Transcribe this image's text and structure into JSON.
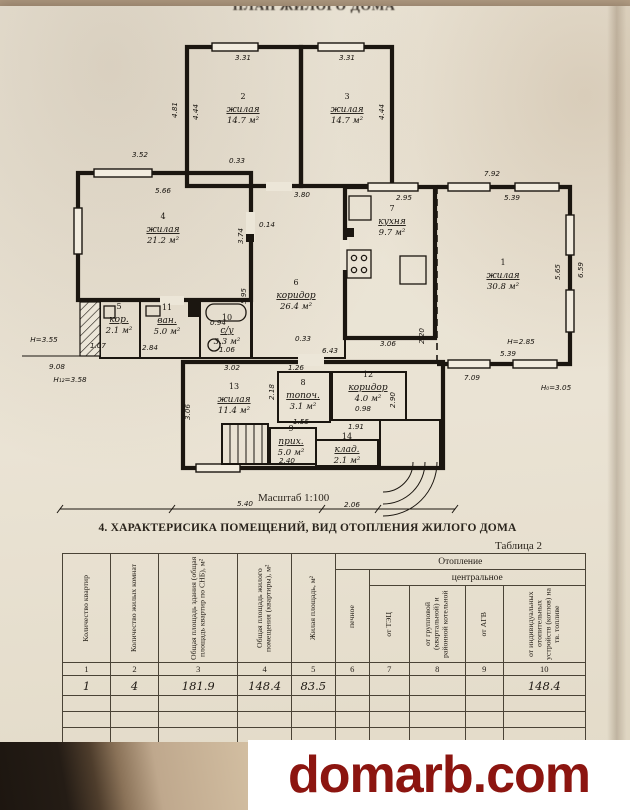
{
  "document": {
    "top_fragment": "ПЛАН ЖИЛОГО ДОМА",
    "scale_label": "Масштаб 1:100",
    "section_heading": "4. ХАРАКТЕРИСИКА ПОМЕЩЕНИЙ, ВИД ОТОПЛЕНИЯ ЖИЛОГО ДОМА",
    "table_caption": "Таблица 2"
  },
  "plan": {
    "rooms": [
      {
        "num": "1",
        "name": "жилая",
        "area": "30.8 м²",
        "x": 503,
        "y": 278
      },
      {
        "num": "2",
        "name": "жилая",
        "area": "14.7 м²",
        "x": 243,
        "y": 112
      },
      {
        "num": "3",
        "name": "жилая",
        "area": "14.7 м²",
        "x": 347,
        "y": 112
      },
      {
        "num": "4",
        "name": "жилая",
        "area": "21.2 м²",
        "x": 163,
        "y": 232
      },
      {
        "num": "5",
        "name": "кор.",
        "area": "2.1 м²",
        "x": 119,
        "y": 322
      },
      {
        "num": "6",
        "name": "коридор",
        "area": "26.4 м²",
        "x": 296,
        "y": 298
      },
      {
        "num": "7",
        "name": "кухня",
        "area": "9.7 м²",
        "x": 392,
        "y": 224
      },
      {
        "num": "8",
        "name": "топоч.",
        "area": "3.1 м²",
        "x": 303,
        "y": 398
      },
      {
        "num": "9",
        "name": "прих.",
        "area": "5.0 м²",
        "x": 291,
        "y": 444
      },
      {
        "num": "10",
        "name": "с/у",
        "area": "3.3 м²",
        "x": 227,
        "y": 333
      },
      {
        "num": "11",
        "name": "ван.",
        "area": "5.0 м²",
        "x": 167,
        "y": 323
      },
      {
        "num": "12",
        "name": "коридор",
        "area": "4.0 м²",
        "x": 368,
        "y": 390
      },
      {
        "num": "13",
        "name": "жилая",
        "area": "11.4 м²",
        "x": 234,
        "y": 402
      },
      {
        "num": "14",
        "name": "клад.",
        "area": "2.1 м²",
        "x": 347,
        "y": 452
      }
    ],
    "dims": [
      {
        "t": "3.52",
        "x": 140,
        "y": 157
      },
      {
        "t": "0.33",
        "x": 237,
        "y": 163
      },
      {
        "t": "5.66",
        "x": 163,
        "y": 193
      },
      {
        "t": "3.80",
        "x": 302,
        "y": 197
      },
      {
        "t": "3.31",
        "x": 243,
        "y": 60
      },
      {
        "t": "3.31",
        "x": 347,
        "y": 60
      },
      {
        "t": "4.81",
        "x": 177,
        "y": 110,
        "r": -90
      },
      {
        "t": "4.44",
        "x": 198,
        "y": 112,
        "r": -90
      },
      {
        "t": "4.44",
        "x": 384,
        "y": 112,
        "r": -90
      },
      {
        "t": "7.92",
        "x": 492,
        "y": 176
      },
      {
        "t": "5.39",
        "x": 512,
        "y": 200
      },
      {
        "t": "2.95",
        "x": 404,
        "y": 200
      },
      {
        "t": "5.65",
        "x": 560,
        "y": 272,
        "r": -90
      },
      {
        "t": "6.59",
        "x": 583,
        "y": 270,
        "r": -90
      },
      {
        "t": "5.39",
        "x": 508,
        "y": 356
      },
      {
        "t": "7.09",
        "x": 472,
        "y": 380
      },
      {
        "t": "Н=2.85",
        "x": 521,
        "y": 344
      },
      {
        "t": "Н₀=3.05",
        "x": 556,
        "y": 390
      },
      {
        "t": "3.74",
        "x": 243,
        "y": 236,
        "r": -90
      },
      {
        "t": "0.14",
        "x": 267,
        "y": 227
      },
      {
        "t": "5.95",
        "x": 246,
        "y": 296,
        "r": -90
      },
      {
        "t": "3.06",
        "x": 388,
        "y": 346
      },
      {
        "t": "2.20",
        "x": 424,
        "y": 336,
        "r": -90
      },
      {
        "t": "6.43",
        "x": 330,
        "y": 353
      },
      {
        "t": "0.33",
        "x": 303,
        "y": 341
      },
      {
        "t": "Н=3.55",
        "x": 44,
        "y": 342
      },
      {
        "t": "9.08",
        "x": 57,
        "y": 369
      },
      {
        "t": "Н₁₂=3.58",
        "x": 70,
        "y": 382
      },
      {
        "t": "1.07",
        "x": 98,
        "y": 348
      },
      {
        "t": "2.84",
        "x": 150,
        "y": 350
      },
      {
        "t": "0.94",
        "x": 218,
        "y": 325
      },
      {
        "t": "1.06",
        "x": 227,
        "y": 352
      },
      {
        "t": "3.02",
        "x": 232,
        "y": 370
      },
      {
        "t": "3.06",
        "x": 190,
        "y": 412,
        "r": -90
      },
      {
        "t": "1.26",
        "x": 296,
        "y": 370
      },
      {
        "t": "2.18",
        "x": 274,
        "y": 392,
        "r": -90
      },
      {
        "t": "1.55",
        "x": 301,
        "y": 424
      },
      {
        "t": "0.98",
        "x": 363,
        "y": 411
      },
      {
        "t": "1.91",
        "x": 356,
        "y": 429
      },
      {
        "t": "2.90",
        "x": 395,
        "y": 400,
        "r": -90
      },
      {
        "t": "2.40",
        "x": 287,
        "y": 463
      },
      {
        "t": "5.40",
        "x": 245,
        "y": 506
      },
      {
        "t": "2.06",
        "x": 352,
        "y": 507
      }
    ]
  },
  "table": {
    "heating_label": "Отопление",
    "central_label": "центральное",
    "columns": [
      "Количество квартир",
      "Количество жилых комнат",
      "Общая площадь здания (общая площадь квартир по СНБ), м²",
      "Общая площадь жилого помещения (квартиры), м²",
      "Жилая площадь, м²",
      "печное",
      "от ТЭЦ",
      "от групповой (квартальной) и районной котельной",
      "от АГВ",
      "от индивидуальных отопительных устройств (котлов) на тв. топливе"
    ],
    "column_numbers": [
      "1",
      "2",
      "3",
      "4",
      "5",
      "6",
      "7",
      "8",
      "9",
      "10"
    ],
    "data_row": [
      "1",
      "4",
      "181.9",
      "148.4",
      "83.5",
      "",
      "",
      "",
      "",
      "148.4"
    ]
  },
  "watermark": {
    "text": "domarb.com",
    "color": "#8c1510"
  }
}
